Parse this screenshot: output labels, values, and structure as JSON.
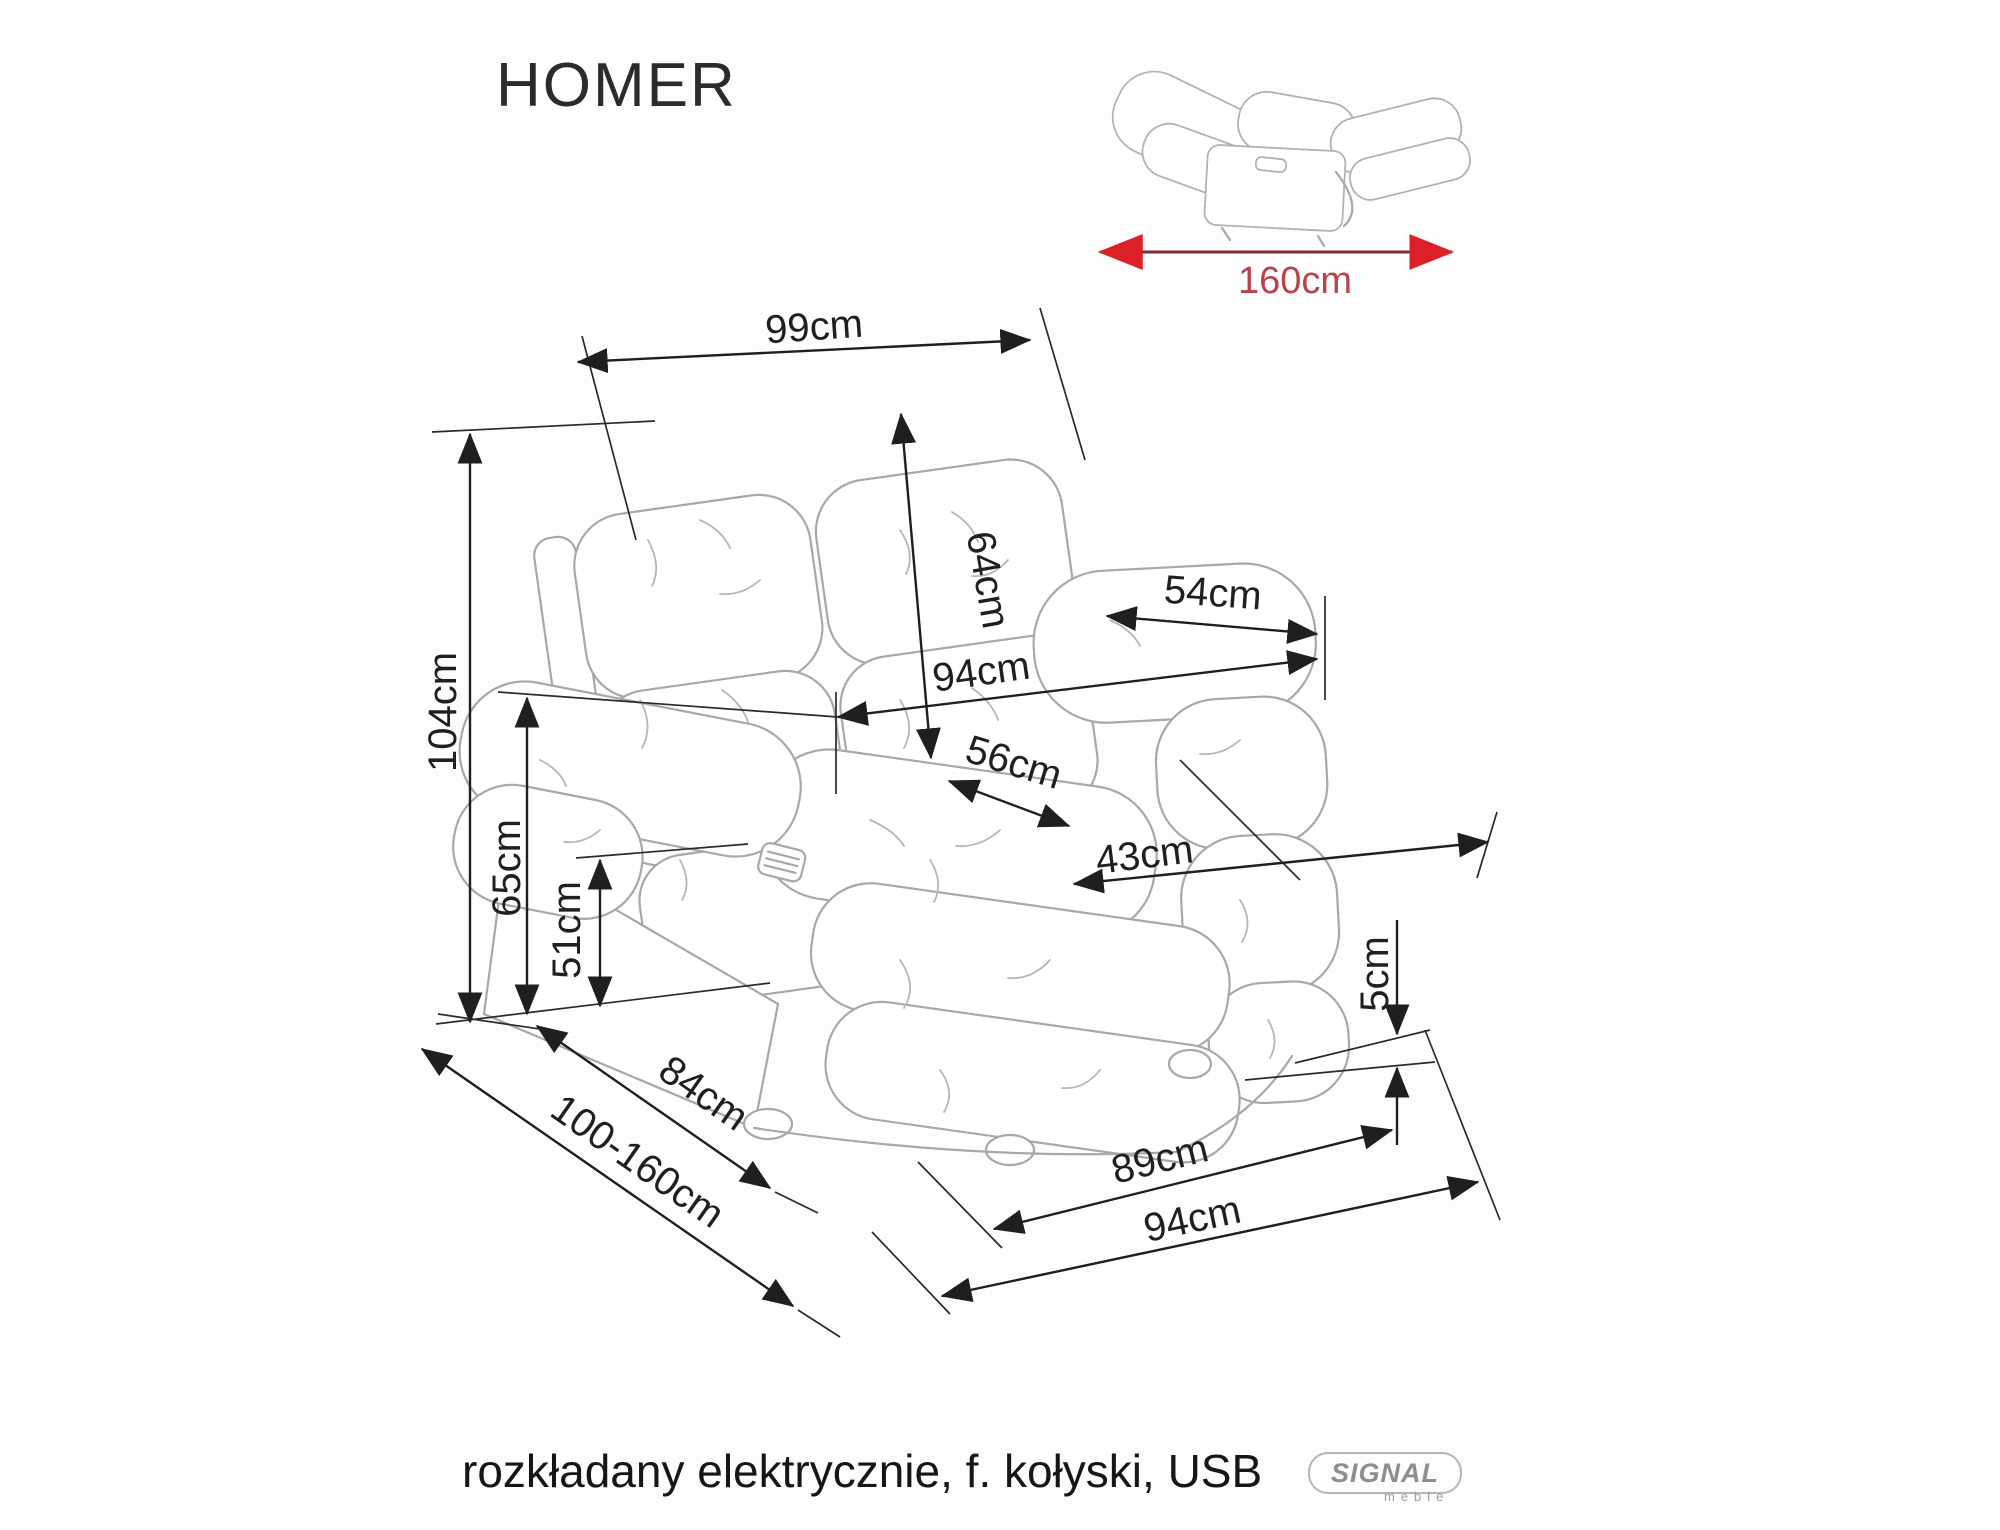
{
  "title": "HOMER",
  "thumbnail": {
    "length_label": "160cm"
  },
  "diagram": {
    "dimensions": [
      {
        "id": "top-width",
        "label": "99cm"
      },
      {
        "id": "backrest-height",
        "label": "64cm"
      },
      {
        "id": "back-to-armrest",
        "label": "54cm"
      },
      {
        "id": "upper-width",
        "label": "94cm"
      },
      {
        "id": "seat-width",
        "label": "56cm"
      },
      {
        "id": "seat-depth",
        "label": "43cm"
      },
      {
        "id": "total-height",
        "label": "104cm"
      },
      {
        "id": "armrest-height",
        "label": "65cm"
      },
      {
        "id": "seat-height",
        "label": "51cm"
      },
      {
        "id": "ground-clearance",
        "label": "5cm"
      },
      {
        "id": "side-depth",
        "label": "84cm"
      },
      {
        "id": "extended-depth",
        "label": "100-160cm"
      },
      {
        "id": "base-width",
        "label": "89cm"
      },
      {
        "id": "overall-width",
        "label": "94cm"
      }
    ]
  },
  "footer": {
    "description": "rozkładany elektrycznie, f. kołyski, USB"
  },
  "logo": {
    "brand": "SIGNAL",
    "sub": "meble"
  },
  "colors": {
    "dimension_black": "#1f1f1f",
    "sketch_gray": "#a8a8a8",
    "red_text": "#b9434a",
    "red_line": "#7d2a33",
    "red_arrowhead": "#dc2027"
  }
}
